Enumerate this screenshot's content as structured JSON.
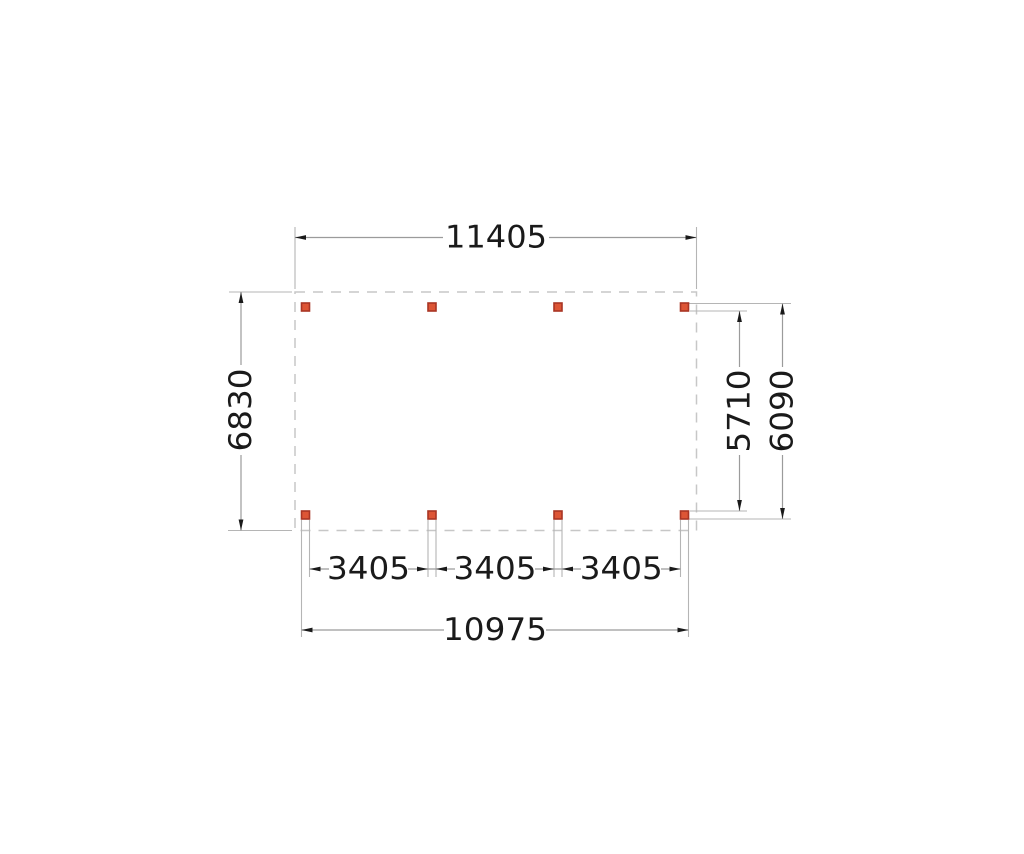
{
  "drawing": {
    "type": "plattegrond-dimension-plan",
    "dimensions": {
      "top_width": "11405",
      "left_depth": "6830",
      "right_inner_depth": "5710",
      "right_outer_depth": "6090",
      "bottom_bays": [
        "3405",
        "3405",
        "3405"
      ],
      "bottom_outer_width": "10975"
    },
    "posts": {
      "count": 8,
      "rows": 2,
      "columns": 4
    },
    "colors": {
      "post_fill": "#dd5535",
      "post_border": "#a93524",
      "dim_line": "#9b9b9b",
      "witness_line": "#b5b5b5",
      "outline_dash": "#c7c7c7",
      "text": "#1a1a1a"
    }
  }
}
